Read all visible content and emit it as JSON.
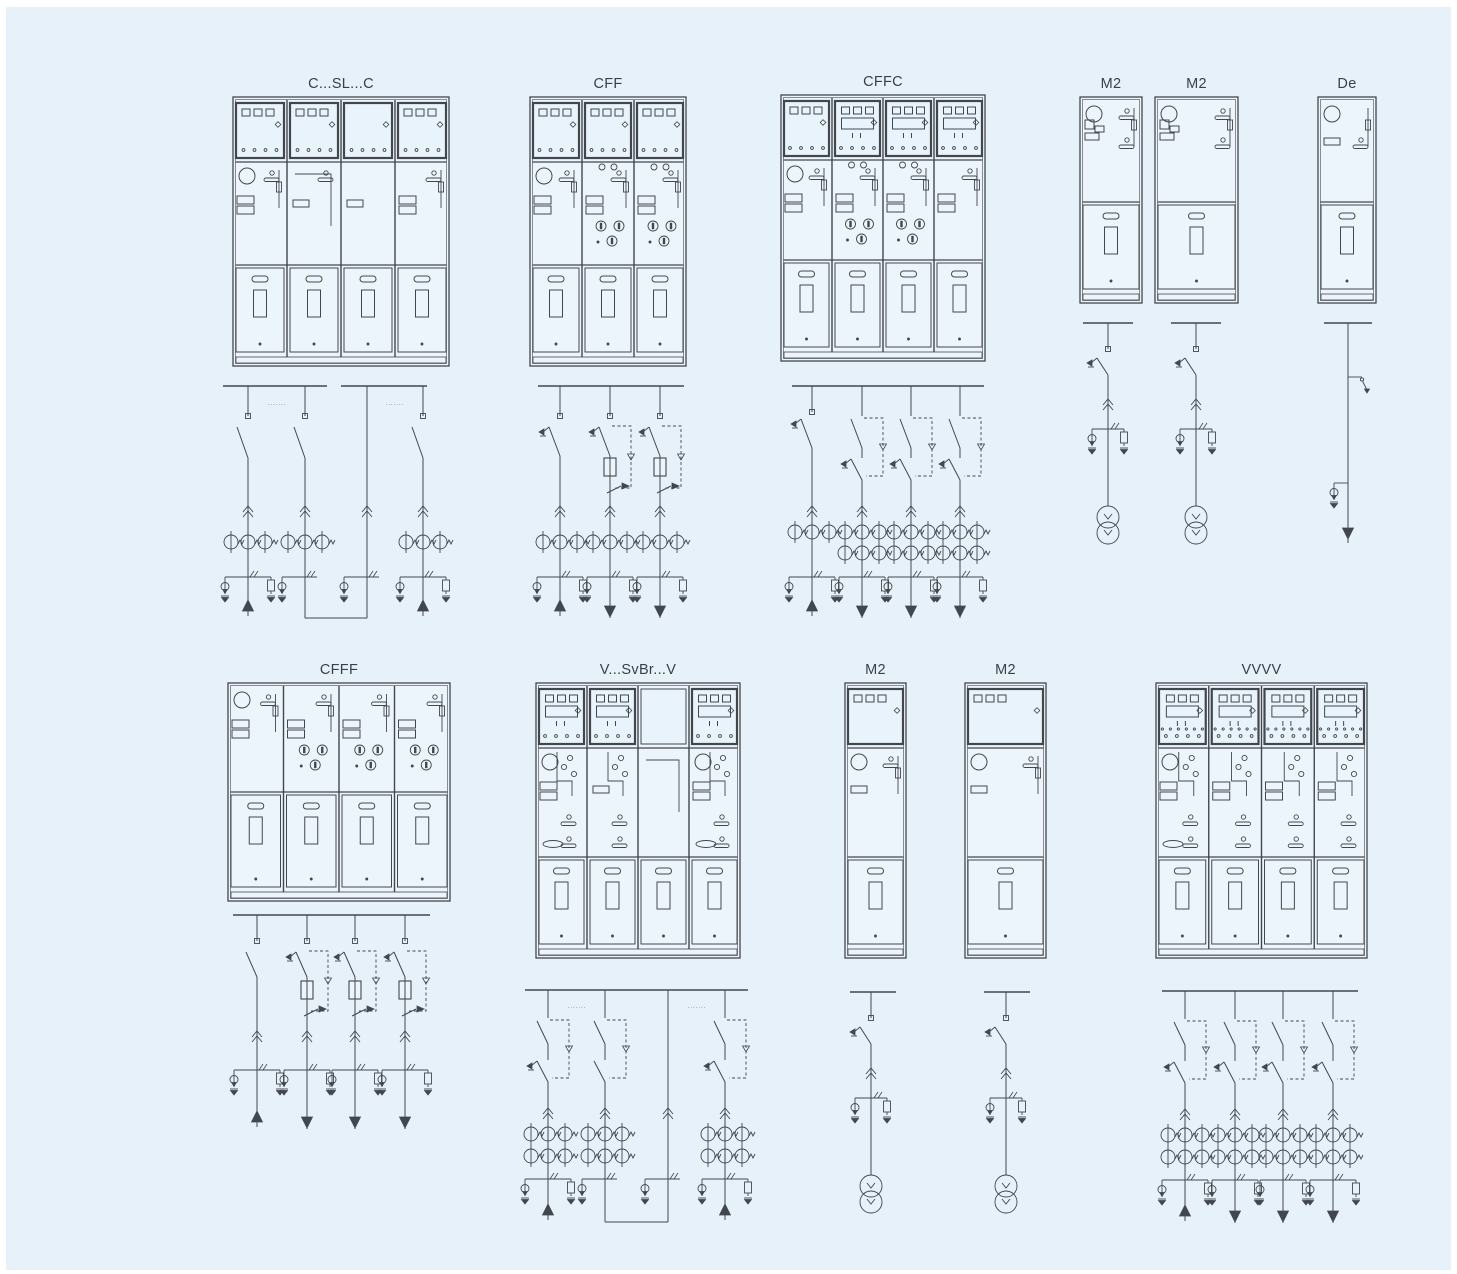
{
  "figure": {
    "description": "Switchgear configuration sheet: cabinet front views with single-line diagrams",
    "background": "#e6f1fa",
    "ink": "#42474d",
    "panel_fill": "#edf5fc",
    "relay_fill": "#e9f3fb"
  },
  "units": [
    {
      "id": "cslc",
      "label": "C...SL...C",
      "cabinet": {
        "x": 233,
        "y": 97,
        "w": 216,
        "h": 269,
        "doorH": 92,
        "relay": [
          "sq",
          "sq",
          "dots",
          "sq"
        ],
        "mech": [
          [
            "circle",
            "handle",
            "stacked",
            "lever"
          ],
          [
            "handle",
            "wide",
            "link"
          ],
          [
            "wide"
          ],
          [
            "handle",
            "stacked",
            "lever"
          ]
        ]
      },
      "diagram": {
        "kind": "ring",
        "busY": 386,
        "buses": [
          [
            223,
            327
          ],
          [
            341,
            427
          ]
        ],
        "notes": [
          {
            "x": 277,
            "y": 406,
            "text": "·······"
          },
          {
            "x": 395,
            "y": 406,
            "text": "·······"
          }
        ],
        "feeders": [
          {
            "x": 248,
            "term": true,
            "blade": "plain",
            "chevron": true,
            "ct": 1,
            "branch": "af",
            "end": "up"
          },
          {
            "x": 305,
            "term": true,
            "blade": "plain",
            "chevron": true,
            "ct": 1,
            "branch": "a",
            "end": "drop"
          },
          {
            "x": 367,
            "chevron": true,
            "branch": "a",
            "end": "drop"
          },
          {
            "x": 423,
            "term": true,
            "blade": "plain",
            "chevron": true,
            "ct": 1,
            "branch": "af",
            "end": "up"
          }
        ],
        "loops": [
          {
            "a": 1,
            "b": 2,
            "y": 618
          }
        ]
      }
    },
    {
      "id": "cff",
      "label": "CFF",
      "cabinet": {
        "x": 530,
        "y": 97,
        "w": 156,
        "h": 269,
        "doorH": 92,
        "relay": [
          "sq",
          "sq",
          "sq"
        ],
        "mech": [
          [
            "circle",
            "handle",
            "stacked",
            "lever"
          ],
          [
            "topdots",
            "handle",
            "stacked",
            "ind",
            "lever"
          ],
          [
            "topdots",
            "handle",
            "stacked",
            "ind",
            "lever"
          ]
        ]
      },
      "diagram": {
        "kind": "fuse1",
        "busY": 386,
        "buses": [
          [
            538,
            684
          ]
        ],
        "feeders": [
          {
            "x": 560,
            "term": true,
            "blade": "earth",
            "chevron": true,
            "ct": 1,
            "branch": "af",
            "end": "up"
          },
          {
            "x": 610,
            "term": true,
            "blade": "earth",
            "trip": true,
            "fuse": true,
            "low": "arrow",
            "chevron": true,
            "ct": 1,
            "branch": "af",
            "end": "down"
          },
          {
            "x": 660,
            "term": true,
            "blade": "earth",
            "trip": true,
            "fuse": true,
            "low": "arrow",
            "chevron": true,
            "ct": 1,
            "branch": "af",
            "end": "down"
          }
        ]
      }
    },
    {
      "id": "cffc",
      "label": "CFFC",
      "cabinet": {
        "x": 781,
        "y": 95,
        "w": 204,
        "h": 266,
        "doorH": 92,
        "relay": [
          "sq",
          "disp",
          "disp",
          "disp"
        ],
        "mech": [
          [
            "circle",
            "handle",
            "stacked",
            "lever"
          ],
          [
            "topdots",
            "handle",
            "stacked",
            "ind",
            "lever"
          ],
          [
            "topdots",
            "handle",
            "stacked",
            "ind",
            "lever"
          ],
          [
            "handle",
            "stacked",
            "lever"
          ]
        ]
      },
      "diagram": {
        "kind": "brk1",
        "busY": 386,
        "buses": [
          [
            792,
            984
          ]
        ],
        "feeders": [
          {
            "x": 812,
            "term": true,
            "blade": "earth",
            "chevron": true,
            "ct": 1,
            "branch": "af",
            "end": "up"
          },
          {
            "x": 862,
            "blade": "plain",
            "trip": true,
            "low": "earth",
            "chevron": true,
            "ct": 2,
            "branch": "af",
            "end": "down"
          },
          {
            "x": 911,
            "blade": "plain",
            "trip": true,
            "low": "earth",
            "chevron": true,
            "ct": 2,
            "branch": "af",
            "end": "down"
          },
          {
            "x": 960,
            "blade": "plain",
            "trip": true,
            "low": "earth",
            "chevron": true,
            "ct": 2,
            "branch": "af",
            "end": "down"
          }
        ]
      }
    },
    {
      "id": "m2-top-1",
      "label": "M2",
      "cabinet": {
        "x": 1080,
        "y": 97,
        "w": 62,
        "h": 206,
        "doorH": 92,
        "mech": [
          [
            "circle",
            "handle",
            "m2block",
            "handle2",
            "lever"
          ]
        ]
      },
      "diagram": {
        "kind": "vt",
        "busY": 323,
        "buses": [
          [
            1083,
            1133
          ]
        ],
        "feeders": [
          {
            "x": 1108,
            "term": true,
            "blade": "earth",
            "chevron": true,
            "branch": "m2",
            "end": "vt"
          }
        ]
      }
    },
    {
      "id": "m2-top-2",
      "label": "M2",
      "cabinet": {
        "x": 1155,
        "y": 97,
        "w": 83,
        "h": 206,
        "doorH": 92,
        "mech": [
          [
            "circle",
            "handle",
            "m2block",
            "handle2",
            "lever"
          ]
        ]
      },
      "diagram": {
        "kind": "vt",
        "busY": 323,
        "buses": [
          [
            1171,
            1221
          ]
        ],
        "feeders": [
          {
            "x": 1196,
            "term": true,
            "blade": "earth",
            "chevron": true,
            "branch": "m2",
            "end": "vt"
          }
        ]
      }
    },
    {
      "id": "de",
      "label": "De",
      "cabinet": {
        "x": 1318,
        "y": 97,
        "w": 58,
        "h": 206,
        "doorH": 92,
        "mech": [
          [
            "circle",
            "wide",
            "handle2",
            "lever"
          ]
        ]
      },
      "diagram": {
        "kind": "de",
        "busY": 323,
        "buses": [
          [
            1324,
            1372
          ]
        ],
        "feeders": [
          {
            "x": 1348,
            "end": "de"
          }
        ]
      }
    },
    {
      "id": "cfff",
      "label": "CFFF",
      "cabinet": {
        "x": 228,
        "y": 683,
        "w": 222,
        "h": 218,
        "doorH": 100,
        "mech": [
          [
            "circle",
            "handle",
            "stacked",
            "lever"
          ],
          [
            "handle",
            "stacked",
            "ind",
            "lever"
          ],
          [
            "handle",
            "stacked",
            "ind",
            "lever"
          ],
          [
            "handle",
            "stacked",
            "ind",
            "lever"
          ]
        ]
      },
      "diagram": {
        "kind": "fuse2",
        "busY": 915,
        "buses": [
          [
            233,
            430
          ]
        ],
        "feeders": [
          {
            "x": 257,
            "term": true,
            "blade": "plain",
            "chevron": true,
            "branch": "af",
            "end": "up"
          },
          {
            "x": 307,
            "term": true,
            "blade": "earth",
            "trip": true,
            "fuse": true,
            "low": "arrow",
            "chevron": true,
            "branch": "af",
            "end": "down"
          },
          {
            "x": 355,
            "term": true,
            "blade": "earth",
            "trip": true,
            "fuse": true,
            "low": "arrow",
            "chevron": true,
            "branch": "af",
            "end": "down"
          },
          {
            "x": 405,
            "term": true,
            "blade": "earth",
            "trip": true,
            "fuse": true,
            "low": "arrow",
            "chevron": true,
            "branch": "af",
            "end": "down"
          }
        ]
      }
    },
    {
      "id": "vsvbrv",
      "label": "V...SvBr...V",
      "cabinet": {
        "x": 536,
        "y": 683,
        "w": 204,
        "h": 275,
        "doorH": 92,
        "relay": [
          "disp",
          "disp",
          "blank",
          "disp"
        ],
        "mech": [
          [
            "circle",
            "scatter",
            "stacked",
            "oval",
            "handleB"
          ],
          [
            "scatter",
            "wide",
            "handleB"
          ],
          [
            "link"
          ],
          [
            "circle",
            "scatter",
            "stacked",
            "oval",
            "handleB"
          ]
        ]
      },
      "diagram": {
        "kind": "brk2",
        "busY": 990,
        "buses": [
          [
            525,
            748
          ]
        ],
        "notes": [
          {
            "x": 577,
            "y": 1009,
            "text": "·······"
          },
          {
            "x": 697,
            "y": 1009,
            "text": "·······"
          }
        ],
        "feeders": [
          {
            "x": 548,
            "blade": "plain",
            "trip": true,
            "low": "earth",
            "chevron": true,
            "ct": 2,
            "branch": "af",
            "end": "up"
          },
          {
            "x": 605,
            "blade": "plain",
            "trip": true,
            "low": "plain",
            "chevron": true,
            "ct": 2,
            "branch": "a",
            "end": "drop"
          },
          {
            "x": 668,
            "chevron": true,
            "branch": "a",
            "end": "drop"
          },
          {
            "x": 725,
            "blade": "plain",
            "trip": true,
            "low": "earth",
            "chevron": true,
            "ct": 2,
            "branch": "af",
            "end": "up"
          }
        ],
        "loops": [
          {
            "a": 1,
            "b": 2,
            "y": 1222
          }
        ]
      }
    },
    {
      "id": "m2-bottom-1",
      "label": "M2",
      "cabinet": {
        "x": 845,
        "y": 683,
        "w": 61,
        "h": 275,
        "doorH": 92,
        "relay": [
          "sq3"
        ],
        "mech": [
          [
            "circle",
            "handle",
            "wide",
            "lever"
          ]
        ]
      },
      "diagram": {
        "kind": "vt",
        "busY": 992,
        "buses": [
          [
            850,
            896
          ]
        ],
        "feeders": [
          {
            "x": 871,
            "term": true,
            "blade": "earth",
            "chevron": true,
            "branch": "m2",
            "end": "vt"
          }
        ]
      }
    },
    {
      "id": "m2-bottom-2",
      "label": "M2",
      "cabinet": {
        "x": 965,
        "y": 683,
        "w": 81,
        "h": 275,
        "doorH": 92,
        "relay": [
          "sq3"
        ],
        "mech": [
          [
            "circle",
            "handle",
            "wide",
            "lever"
          ]
        ]
      },
      "diagram": {
        "kind": "vt",
        "busY": 992,
        "buses": [
          [
            984,
            1030
          ]
        ],
        "feeders": [
          {
            "x": 1006,
            "term": true,
            "blade": "earth",
            "chevron": true,
            "branch": "m2",
            "end": "vt"
          }
        ]
      }
    },
    {
      "id": "vvvv",
      "label": "VVVV",
      "cabinet": {
        "x": 1156,
        "y": 683,
        "w": 211,
        "h": 275,
        "doorH": 92,
        "relay": [
          "disp2",
          "disp2",
          "disp2",
          "disp2"
        ],
        "mech": [
          [
            "circle",
            "scatter",
            "stacked",
            "oval",
            "handleB"
          ],
          [
            "scatter",
            "stacked",
            "handleB"
          ],
          [
            "scatter",
            "stacked",
            "handleB"
          ],
          [
            "scatter",
            "stacked",
            "handleB"
          ]
        ]
      },
      "diagram": {
        "kind": "brk2",
        "busY": 991,
        "buses": [
          [
            1162,
            1358
          ]
        ],
        "feeders": [
          {
            "x": 1185,
            "blade": "plain",
            "trip": true,
            "low": "earth",
            "chevron": true,
            "ct": 2,
            "branch": "af",
            "end": "up"
          },
          {
            "x": 1235,
            "blade": "plain",
            "trip": true,
            "low": "earth",
            "chevron": true,
            "ct": 2,
            "branch": "af",
            "end": "down"
          },
          {
            "x": 1283,
            "blade": "plain",
            "trip": true,
            "low": "earth",
            "chevron": true,
            "ct": 2,
            "branch": "af",
            "end": "down"
          },
          {
            "x": 1333,
            "blade": "plain",
            "trip": true,
            "low": "earth",
            "chevron": true,
            "ct": 2,
            "branch": "af",
            "end": "down"
          }
        ]
      }
    }
  ]
}
